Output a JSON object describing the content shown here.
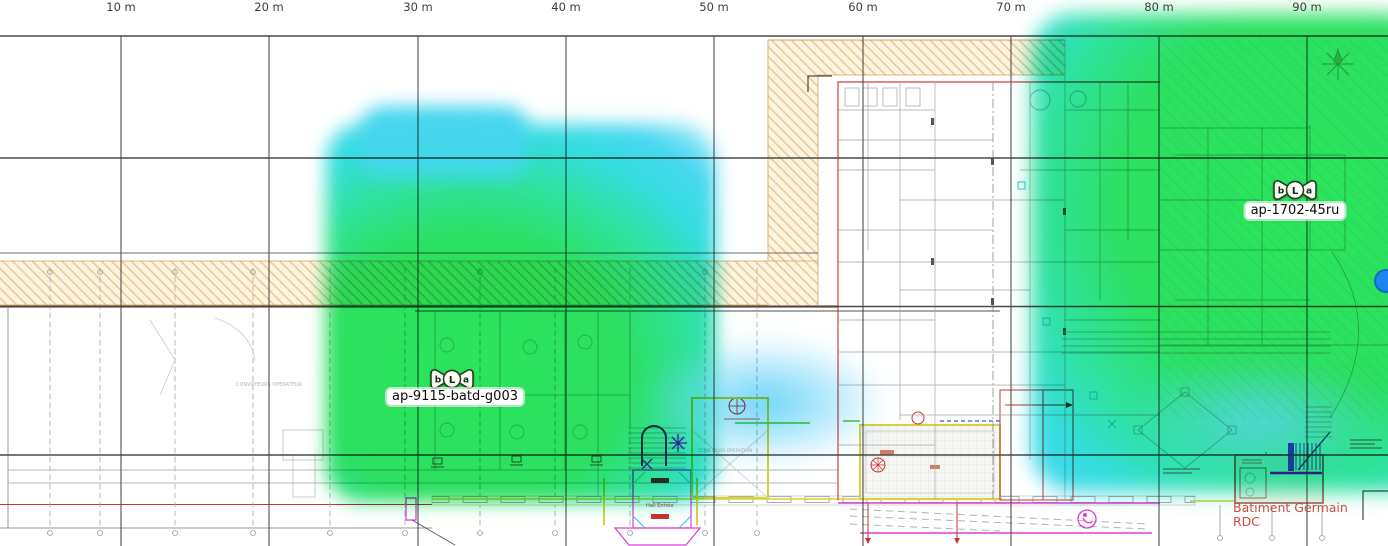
{
  "ruler": {
    "labels": [
      "10 m",
      "20 m",
      "30 m",
      "40 m",
      "50 m",
      "60 m",
      "70 m",
      "80 m",
      "90 m"
    ]
  },
  "access_points": [
    {
      "name": "ap-9115-batd-g003",
      "radios": [
        "b",
        "L",
        "a"
      ]
    },
    {
      "name": "ap-1702-45ru",
      "radios": [
        "b",
        "L",
        "a"
      ]
    }
  ],
  "plan_labels": {
    "building_line1": "Batiment Germain",
    "building_line2": "RDC",
    "conveyors": "CONVOYEURS OPERATEUR",
    "zone": "ZONE HORS OPERATION",
    "hall": "Hall Entrée"
  },
  "heatmap": {
    "core_color": "#2be45c",
    "mid_color": "#2fe2a0",
    "edge_color": "#4ad7f2",
    "blend_mode": "multiply"
  }
}
